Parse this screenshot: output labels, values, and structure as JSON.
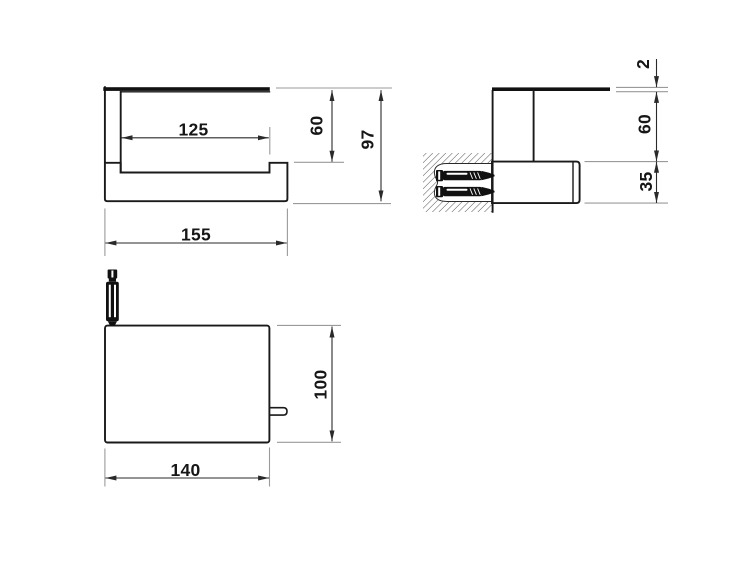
{
  "drawing": {
    "type": "technical-dimension-drawing",
    "background_color": "#ffffff",
    "object_line_color": "#1a1a1a",
    "dimension_line_color": "#2a2a2a",
    "extension_line_color": "#9a9a9a",
    "views": {
      "front": {
        "description": "front elevation of wall-mounted roll holder with cover",
        "dims": {
          "inner_width": "125",
          "overall_width": "155",
          "drop_height": "60",
          "overall_height": "97"
        }
      },
      "side": {
        "description": "side section at wall with two anchor screws in hatched wall block",
        "dims": {
          "plate_thickness": "2",
          "drop_height": "60",
          "bar_height": "35"
        }
      },
      "bottom": {
        "description": "plan view of cover plate with anchor screw and side pin",
        "dims": {
          "width": "140",
          "depth": "100"
        }
      }
    }
  }
}
